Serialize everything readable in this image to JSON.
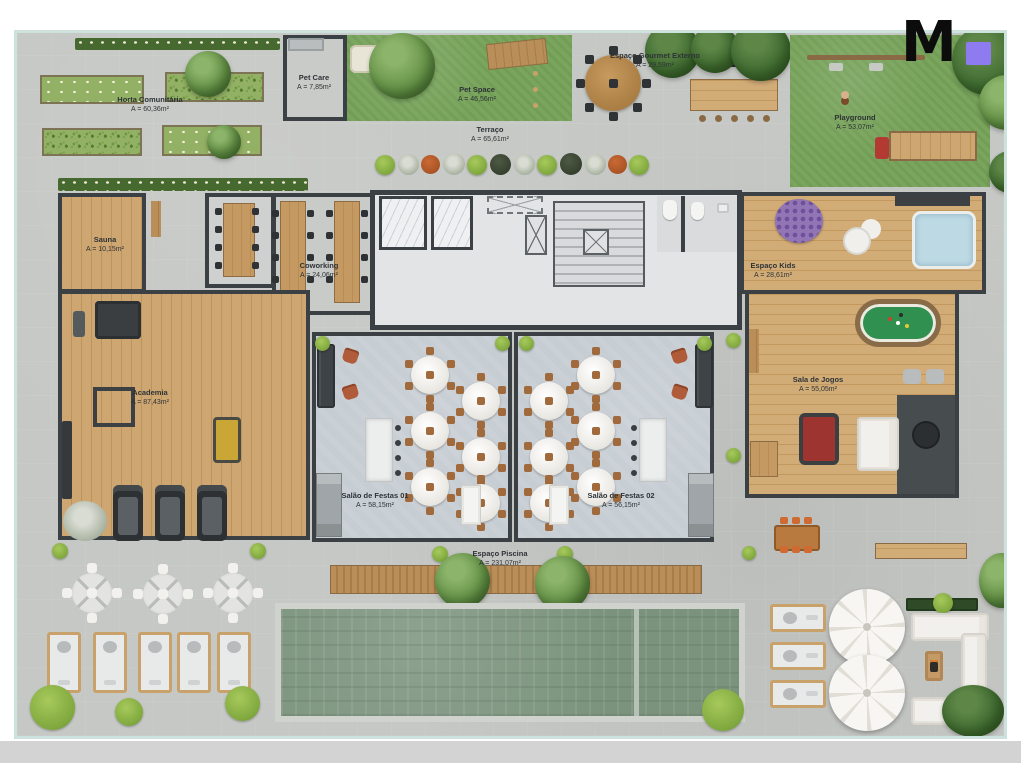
{
  "logo": {
    "letter": "M",
    "square_color": "#8e7bef",
    "letter_color": "#0c0c0c"
  },
  "plan": {
    "type": "condominium-amenities-floor-plan",
    "border_color": "#cde2dd",
    "colors": {
      "wall": "#3a4044",
      "concrete": "#c6c8c5",
      "grass": "#79a55c",
      "wood": "#c9a26d",
      "party_floor": "#c6cdd3",
      "pool_water": "#7b937d",
      "terracotta": "#b05c3a",
      "billiard_green": "#2f9050",
      "bottom_bar": "#d2d3d2"
    },
    "rooms": {
      "horta": {
        "name": "Horta Comunitária",
        "area": "A = 60,36m²"
      },
      "pet_care": {
        "name": "Pet Care",
        "area": "A = 7,85m²"
      },
      "pet_space": {
        "name": "Pet Space",
        "area": "A = 46,56m²"
      },
      "gourmet": {
        "name": "Espaço Gourmet Externo",
        "area": "A = 29,59m²"
      },
      "playground": {
        "name": "Playground",
        "area": "A = 53,07m²"
      },
      "terraco": {
        "name": "Terraço",
        "area": "A = 65,61m²"
      },
      "sauna": {
        "name": "Sauna",
        "area": "A = 10,15m²"
      },
      "coworking": {
        "name": "Coworking",
        "area": "A = 24,06m²"
      },
      "academia": {
        "name": "Academia",
        "area": "A = 87,43m²"
      },
      "espaco_kids": {
        "name": "Espaço Kids",
        "area": "A = 28,61m²"
      },
      "sala_jogos": {
        "name": "Sala de Jogos",
        "area": "A = 55,05m²"
      },
      "salao1": {
        "name": "Salão de Festas 01",
        "area": "A = 58,15m²"
      },
      "salao2": {
        "name": "Salão de Festas 02",
        "area": "A = 56,15m²"
      },
      "piscina": {
        "name": "Espaço Piscina",
        "area": "A = 231,07m²"
      }
    }
  }
}
